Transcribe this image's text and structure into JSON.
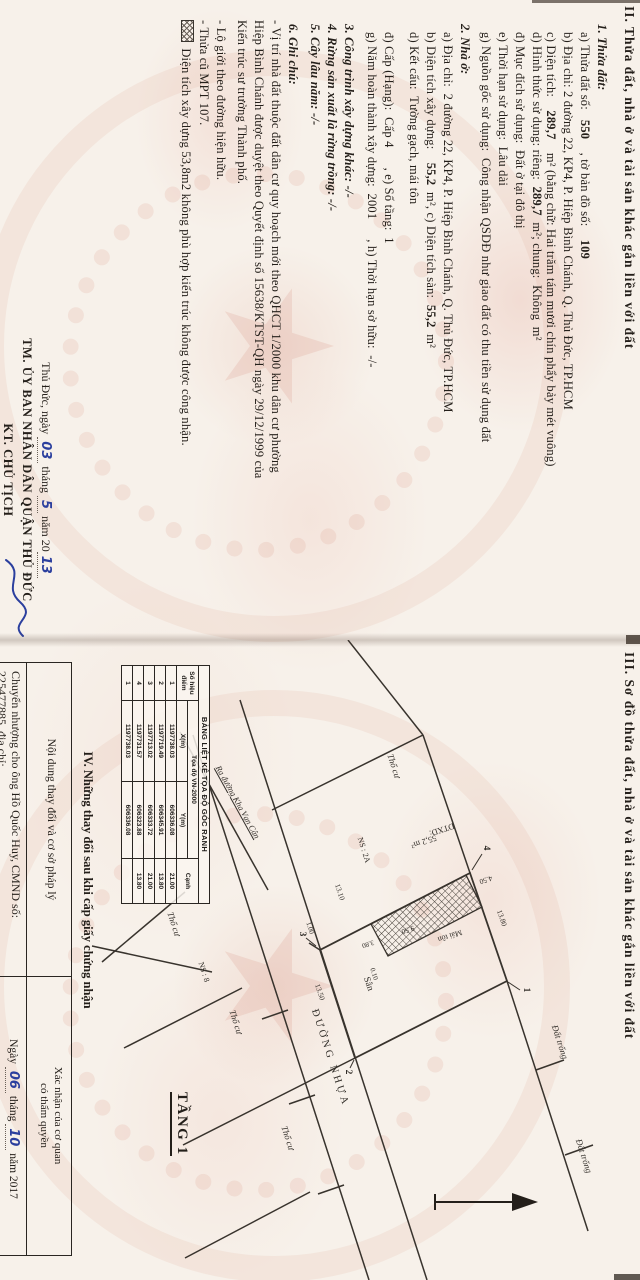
{
  "page2": {
    "heading": "II. Thửa đất, nhà ở và tài sản khác gắn liền với đất",
    "lines": [
      {
        "ind": 14,
        "parts": [
          {
            "t": "1. Thửa đất:",
            "b": 1,
            "i": 1
          }
        ]
      },
      {
        "ind": 22,
        "parts": [
          {
            "t": "a) Thửa đất số:   "
          },
          {
            "t": "550",
            "b": 1
          },
          {
            "t": "    , tờ bản đồ số:    "
          },
          {
            "t": "109",
            "b": 1
          }
        ]
      },
      {
        "ind": 22,
        "parts": [
          {
            "t": "b) Địa chỉ: 2 đường 22, KP4, P. Hiệp Bình Chánh, Q. Thủ Đức, TP.HCM"
          }
        ]
      },
      {
        "ind": 22,
        "parts": [
          {
            "t": "c) Diện tích:    "
          },
          {
            "t": "289,7",
            "b": 1
          },
          {
            "t": "    m² (bằng chữ: Hai trăm tám mươi chín phẩy bảy mét vuông)"
          }
        ]
      },
      {
        "ind": 22,
        "mt": -3,
        "parts": [
          {
            "t": "d) Hình thức sử dụng: riêng:  "
          },
          {
            "t": "289,7",
            "b": 1
          },
          {
            "t": "  m²; chung:  Không  m²"
          }
        ]
      },
      {
        "ind": 22,
        "parts": [
          {
            "t": "đ) Mục đích sử dụng:  Đất ở tại đô thị"
          }
        ]
      },
      {
        "ind": 22,
        "parts": [
          {
            "t": "e) Thời hạn sử dụng:  Lâu dài"
          }
        ]
      },
      {
        "ind": 22,
        "parts": [
          {
            "t": "g) Nguồn gốc sử dụng:  Công nhận QSDĐ như giao đất có thu tiền sử dụng đất"
          }
        ]
      },
      {
        "ind": 14,
        "mt": 4,
        "parts": [
          {
            "t": "2. Nhà ở:",
            "b": 1,
            "i": 1
          }
        ]
      },
      {
        "ind": 22,
        "parts": [
          {
            "t": "a) Địa chỉ:  2 đường 22, KP4, P. Hiệp Bình Chánh, Q. Thủ Đức, TP.HCM"
          }
        ]
      },
      {
        "ind": 22,
        "parts": [
          {
            "t": "b) Diện tích xây dựng:    "
          },
          {
            "t": "55,2",
            "b": 1
          },
          {
            "t": "  m², c) Diện tích sàn:  "
          },
          {
            "t": "55,2",
            "b": 1
          },
          {
            "t": "  m²"
          }
        ]
      },
      {
        "ind": 22,
        "parts": [
          {
            "t": "d) Kết cấu:  Tường gạch, mái tôn"
          }
        ]
      },
      {
        "ind": 22,
        "mt": 8,
        "parts": [
          {
            "t": "đ) Cấp (Hạng):  Cấp 4      , e) Số tầng:  1"
          }
        ]
      },
      {
        "ind": 22,
        "parts": [
          {
            "t": "g) Năm hoàn thành xây dựng:  2001      , h) Thời hạn sở hữu:  -/-"
          }
        ]
      },
      {
        "ind": 14,
        "mt": 6,
        "parts": [
          {
            "t": "3. Công trình xây dựng khác: -/-",
            "b": 1,
            "i": 1
          }
        ]
      },
      {
        "ind": 14,
        "parts": [
          {
            "t": "4. Rừng sản xuất là rừng trồng: -/-",
            "b": 1,
            "i": 1
          }
        ]
      },
      {
        "ind": 14,
        "parts": [
          {
            "t": "5. Cây lâu năm: -/-",
            "b": 1,
            "i": 1
          }
        ]
      },
      {
        "ind": 14,
        "mt": 5,
        "parts": [
          {
            "t": "6. Ghi chú:",
            "b": 1,
            "i": 1
          }
        ]
      },
      {
        "ind": 10,
        "parts": [
          {
            "t": "- Vị trí nhà đất thuộc đất dân cư quy hoạch mới theo QHCT 1/2000 khu dân cư phường"
          }
        ]
      },
      {
        "ind": 10,
        "parts": [
          {
            "t": "Hiệp Bình Chánh được duyệt theo Quyết định số 15638/KTST-QH ngày 29/12/1999 của"
          }
        ]
      },
      {
        "ind": 10,
        "parts": [
          {
            "t": "Kiến trúc sư trưởng Thành phố."
          }
        ]
      },
      {
        "ind": 10,
        "mt": 4,
        "parts": [
          {
            "t": "- Lộ giới theo đường hiện hữu."
          }
        ]
      },
      {
        "ind": 10,
        "parts": [
          {
            "t": "- Thửa cũ MPT 107."
          }
        ]
      },
      {
        "ind": 10,
        "mt": 1,
        "parts": [
          {
            "hatch": 1
          },
          {
            "t": " Diện tích xây dựng 53,8m2 không phù hợp kiến trúc không được công nhận."
          }
        ]
      }
    ],
    "signature": {
      "place": "Thủ Đức, ngày",
      "day": "03",
      "thang_label": "tháng",
      "month": "5",
      "nam_label": "năm 20",
      "year": "13",
      "org": "TM. ỦY BAN NHÂN DÂN QUẬN THỦ ĐỨC",
      "title": "KT. CHỦ TỊCH"
    }
  },
  "page3": {
    "heading": "III. Sơ đồ thửa đất, nhà ở và tài sản khác gắn liền với đất",
    "floor_label": "TẦNG 1",
    "coord_table": {
      "title": "BẢNG LIỆT KÊ TỌA ĐỘ GÓC RANH",
      "col_point": "Số hiệu điểm",
      "col_group": "Tọa độ VN-2000",
      "col_x": "X(m)",
      "col_y": "Y(m)",
      "col_side": "Cạnh",
      "rows": [
        [
          "1",
          "1197738.03",
          "606336.08",
          "21.00"
        ],
        [
          "2",
          "1197719.49",
          "606345.91",
          "13.80"
        ],
        [
          "3",
          "1197713.02",
          "606333.72",
          "21.00"
        ],
        [
          "4",
          "1197731.57",
          "606323.88",
          "13.80"
        ],
        [
          "1",
          "1197738.03",
          "606336.08",
          ""
        ]
      ]
    },
    "map_labels": [
      {
        "t": "ĐƯỜNG NHỰA",
        "x": 418,
        "y": 310,
        "r": -18,
        "s": 10.5,
        "ls": 3
      },
      {
        "t": "Ra đường Kha Vạn Cân",
        "x": 162,
        "y": 402,
        "r": -29,
        "s": 8.5,
        "i": 1,
        "u": 1
      },
      {
        "t": "Thổ cư",
        "x": 126,
        "y": 246,
        "r": -18,
        "s": 9,
        "i": 1
      },
      {
        "t": "Thổ cư",
        "x": 382,
        "y": 404,
        "r": -18,
        "s": 9,
        "i": 1
      },
      {
        "t": "Thổ cư",
        "x": 498,
        "y": 352,
        "r": -18,
        "s": 9,
        "i": 1
      },
      {
        "t": "Thổ cư",
        "x": 284,
        "y": 466,
        "r": -18,
        "s": 9,
        "i": 1
      },
      {
        "t": "Đất trống",
        "x": 402,
        "y": 80,
        "r": -18,
        "s": 9,
        "i": 1
      },
      {
        "t": "Đất trống",
        "x": 516,
        "y": 56,
        "r": -18,
        "s": 9,
        "i": 1
      },
      {
        "t": "NS : 2A",
        "x": 210,
        "y": 276,
        "r": -18,
        "s": 8
      },
      {
        "t": "NS : 8",
        "x": 332,
        "y": 436,
        "r": -18,
        "s": 8
      },
      {
        "t": "Sân",
        "x": 344,
        "y": 272,
        "r": -18,
        "s": 9.5
      },
      {
        "t": "13.80",
        "x": 278,
        "y": 138,
        "r": -19,
        "s": 7.5
      },
      {
        "t": "13.10",
        "x": 252,
        "y": 300,
        "r": -18,
        "s": 7.5
      },
      {
        "t": "1.00",
        "x": 288,
        "y": 330,
        "r": -18,
        "s": 7
      },
      {
        "t": "13.50",
        "x": 352,
        "y": 320,
        "r": -18,
        "s": 7.5
      },
      {
        "t": "4.50",
        "x": 240,
        "y": 154,
        "r": 72,
        "s": 7.5
      },
      {
        "t": "9.50",
        "x": 290,
        "y": 232,
        "r": 72,
        "s": 7.5
      },
      {
        "t": "3.80",
        "x": 304,
        "y": 272,
        "r": 72,
        "s": 7
      },
      {
        "t": "0.10",
        "x": 334,
        "y": 266,
        "r": -18,
        "s": 7
      },
      {
        "t": "DTXD:",
        "x": 190,
        "y": 198,
        "r": 72,
        "s": 8.5
      },
      {
        "t": "55,2 m²",
        "x": 202,
        "y": 216,
        "r": 72,
        "s": 8.5
      },
      {
        "t": "Mái tôn",
        "x": 296,
        "y": 190,
        "r": 72,
        "s": 8
      },
      {
        "t": "1",
        "x": 350,
        "y": 114,
        "s": 9.5,
        "b": 1
      },
      {
        "t": "2",
        "x": 432,
        "y": 292,
        "s": 9.5,
        "b": 1
      },
      {
        "t": "3",
        "x": 294,
        "y": 338,
        "s": 9.5,
        "b": 1
      },
      {
        "t": "4",
        "x": 208,
        "y": 154,
        "s": 9.5,
        "b": 1
      }
    ],
    "section4": {
      "heading": "IV. Những thay đổi sau khi cấp giấy chứng nhận",
      "col_left": "Nội dung thay đổi và cơ sở pháp lý",
      "col_right_1": "Xác nhận của cơ quan",
      "col_right_2": "có thẩm quyền",
      "row_left": "Chuyển nhượng cho ông Hồ Quốc Huy, CMND số: 225477885, địa chỉ:",
      "ngay_label": "Ngày",
      "day": "06",
      "thang_label": "tháng",
      "month": "10",
      "nam_label": "năm 2017"
    }
  },
  "colors": {
    "paper": "#f7f1ea",
    "ink": "#241f1a",
    "handwriting_blue": "#2b3f9e",
    "emblem_pink": "#d6907e"
  }
}
